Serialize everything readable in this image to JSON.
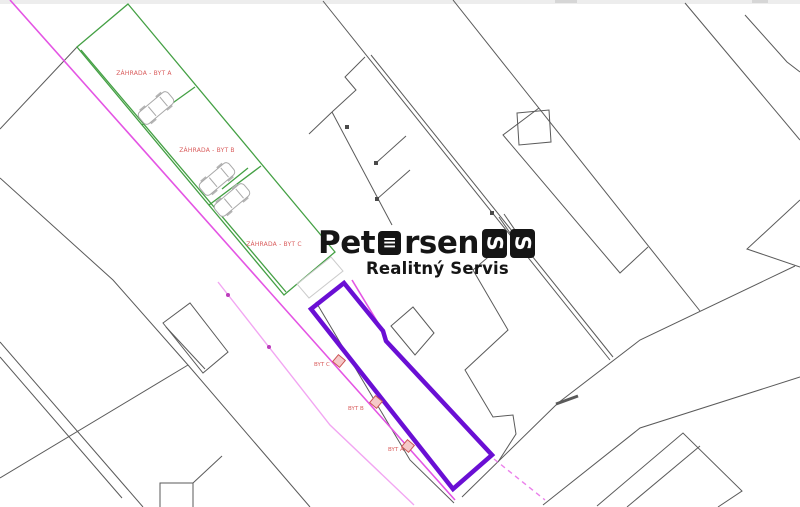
{
  "map": {
    "garden_labels": [
      "ZÁHRADA - BYT A",
      "ZÁHRADA - BYT B",
      "ZÁHRADA - BYT C"
    ],
    "unit_labels": [
      "BYT C",
      "BYT B",
      "BYT A"
    ]
  },
  "logo": {
    "part1": "Pet",
    "e_glyph": "≡",
    "part2": "rsen",
    "mark_glyph": "S",
    "subtitle": "Realitný Servis"
  },
  "colors": {
    "line": "#5a5a5a",
    "magenta": "#e455e4",
    "pink": "#f2a6f2",
    "green": "#44a044",
    "purple": "#6a0fd4",
    "red": "#d95c5c",
    "car": "#a8a8a8",
    "marker-fill": "#f5c9c9",
    "marker-stroke": "#cc5555"
  }
}
